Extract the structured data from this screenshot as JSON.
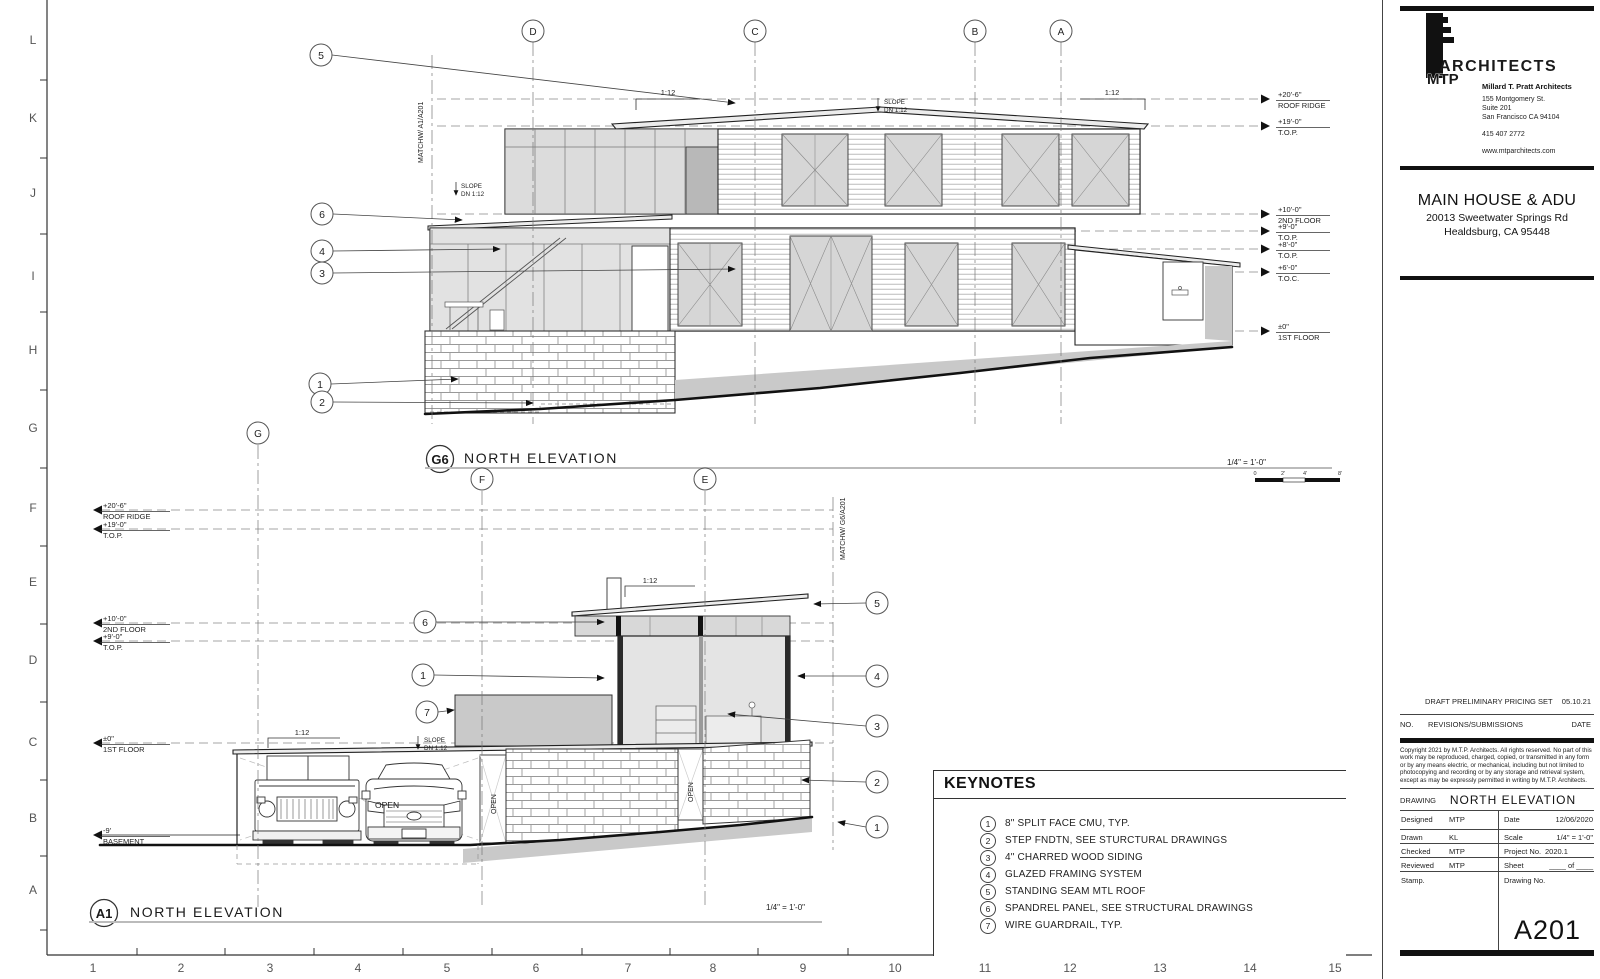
{
  "sheet": {
    "border_letters": [
      "L",
      "K",
      "J",
      "I",
      "H",
      "G",
      "F",
      "E",
      "D",
      "C",
      "B",
      "A"
    ],
    "border_numbers": [
      "1",
      "2",
      "3",
      "4",
      "5",
      "6",
      "7",
      "8",
      "9",
      "10",
      "11",
      "12",
      "13",
      "14",
      "15"
    ]
  },
  "titleblock": {
    "logo": {
      "mtp": "MTP",
      "architects": "ARCHITECTS"
    },
    "firm": "Millard T. Pratt Architects",
    "address1": "155 Montgomery St.",
    "address2": "Suite 201",
    "address3": "San Francisco  CA  94104",
    "phone": "415 407 2772",
    "website": "www.mtparchitects.com",
    "project": {
      "name": "MAIN HOUSE & ADU",
      "address1": "20013 Sweetwater Springs Rd",
      "address2": "Healdsburg, CA  95448"
    },
    "submission": {
      "label": "DRAFT PRELIMINARY PRICING SET",
      "date": "05.10.21"
    },
    "revisions": {
      "no": "NO.",
      "title": "REVISIONS/SUBMISSIONS",
      "date": "DATE"
    },
    "copyright": "Copyright 2021 by M.T.P. Architects. All rights reserved. No part of this work may be reproduced, charged, copied, or transmitted in any form or by any means electric, or mechanical, including but not limited to photocopying and recording or by any storage and retrieval system, except as may be expressly permitted in writing by M.T.P. Architects.",
    "drawing": {
      "label": "DRAWING",
      "title": "NORTH ELEVATION"
    },
    "fields": {
      "designed_label": "Designed",
      "designed": "MTP",
      "date_label": "Date",
      "date": "12/06/2020",
      "drawn_label": "Drawn",
      "drawn": "KL",
      "scale_label": "Scale",
      "scale": "1/4\"  =  1'-0\"",
      "checked_label": "Checked",
      "checked": "MTP",
      "project_no_label": "Project No.",
      "project_no": "2020.1",
      "reviewed_label": "Reviewed",
      "reviewed": "MTP",
      "sheet_label": "Sheet",
      "sheet_of": "____ of ____",
      "stamp_label": "Stamp.",
      "drawing_no_label": "Drawing No.",
      "sheet_number": "A201"
    }
  },
  "keynotes": {
    "title": "KEYNOTES",
    "items": [
      {
        "num": "1",
        "text": "8\" SPLIT FACE CMU, TYP."
      },
      {
        "num": "2",
        "text": "STEP FNDTN, SEE STURCTURAL DRAWINGS"
      },
      {
        "num": "3",
        "text": "4\" CHARRED WOOD SIDING"
      },
      {
        "num": "4",
        "text": "GLAZED FRAMING SYSTEM"
      },
      {
        "num": "5",
        "text": "STANDING SEAM MTL ROOF"
      },
      {
        "num": "6",
        "text": "SPANDREL PANEL, SEE STRUCTURAL DRAWINGS"
      },
      {
        "num": "7",
        "text": "WIRE GUARDRAIL, TYP."
      }
    ]
  },
  "g6": {
    "tag": "G6",
    "title": "NORTH ELEVATION",
    "scale": "1/4\"  =  1'-0\"",
    "matchline": "MATCHW/ A1/A201",
    "grids": [
      "D",
      "C",
      "B",
      "A"
    ],
    "slope_ratio": "1:12",
    "slope_note": {
      "l1": "SLOPE",
      "l2": "DN 1:12"
    },
    "levels": [
      {
        "value": "+20'-6\"",
        "name": "ROOF RIDGE"
      },
      {
        "value": "+19'-0\"",
        "name": "T.O.P."
      },
      {
        "value": "+10'-0\"",
        "name": "2ND FLOOR"
      },
      {
        "value": "+9'-0\"",
        "name": "T.O.P."
      },
      {
        "value": "+8'-0\"",
        "name": "T.O.P."
      },
      {
        "value": "+6'-0\"",
        "name": "T.O.C."
      },
      {
        "value": "±0\"",
        "name": "1ST FLOOR"
      }
    ],
    "scalebar": {
      "t0": "0",
      "t1": "2'",
      "t2": "4'",
      "t3": "8'"
    }
  },
  "a1": {
    "tag": "A1",
    "title": "NORTH ELEVATION",
    "scale": "1/4\"  =  1'-0\"",
    "matchline": "MATCHW/ G6/A201",
    "grids": [
      "G",
      "F",
      "E"
    ],
    "slope_ratio": "1:12",
    "slope_note": {
      "l1": "SLOPE",
      "l2": "DN 1:12"
    },
    "open": "OPEN",
    "levels": [
      {
        "value": "+20'-6\"",
        "name": "ROOF RIDGE"
      },
      {
        "value": "+19'-0\"",
        "name": "T.O.P."
      },
      {
        "value": "+10'-0\"",
        "name": "2ND FLOOR"
      },
      {
        "value": "+9'-0\"",
        "name": "T.O.P."
      },
      {
        "value": "±0\"",
        "name": "1ST FLOOR"
      },
      {
        "value": "-9'",
        "name": "BASEMENT"
      }
    ]
  }
}
